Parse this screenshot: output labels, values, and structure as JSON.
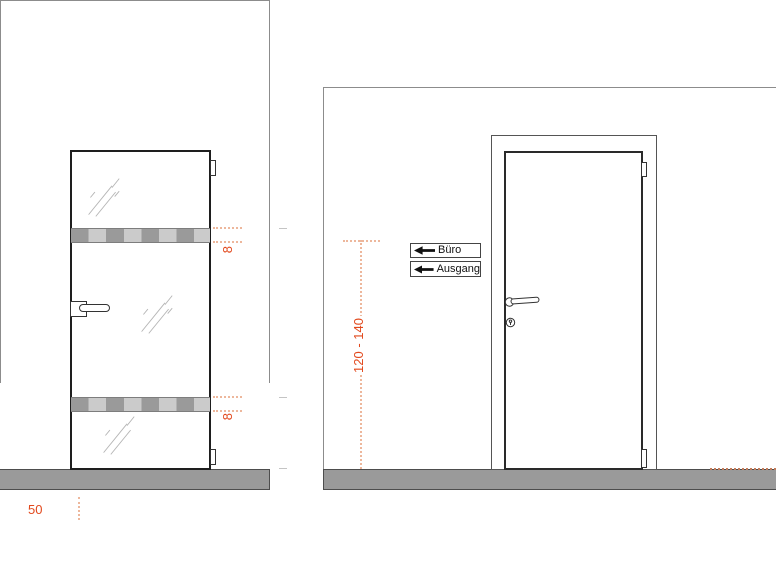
{
  "colors": {
    "accent": "#e2491d",
    "dim_dotted": "#edb79c",
    "floor_gray": "#9a9a9a",
    "stripe_dark": "#9a9a9a",
    "stripe_light": "#cbcbcb",
    "wall_outline": "#8c8c8c",
    "door_outline": "#1e1e1e"
  },
  "left_view": {
    "stripe_dims": [
      {
        "label": "8"
      },
      {
        "label": "8"
      }
    ],
    "floor_dim_label": "50"
  },
  "right_view": {
    "signs": [
      {
        "icon": "arrow-left-icon",
        "label": "Büro"
      },
      {
        "icon": "arrow-left-icon",
        "label": "Ausgang"
      }
    ],
    "height_dim_label": "120 - 140"
  }
}
